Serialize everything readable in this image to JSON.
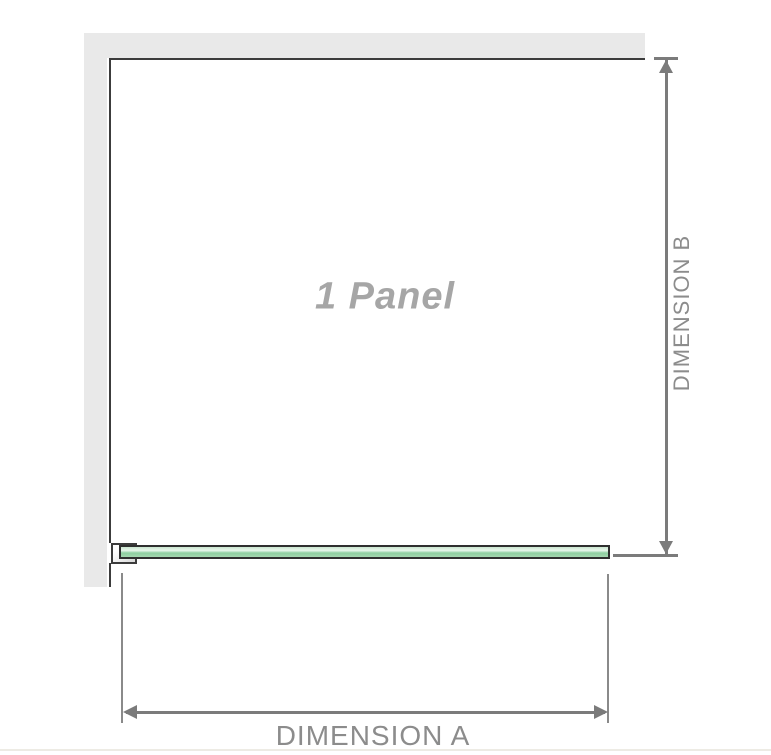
{
  "diagram": {
    "panel_label": "1 Panel",
    "dimension_a": {
      "label": "DIMENSION A"
    },
    "dimension_b": {
      "label": "DIMENSION B"
    }
  },
  "colors": {
    "background": "#ffffff",
    "wall": "#e9e9e9",
    "outline": "#3c3c3c",
    "glass-border": "#2f2f2f",
    "glass-top": "#c9e6cf",
    "glass-light": "#e9f6ec",
    "glass-mid": "#8ecfa0",
    "glass-bottom": "#a5d7b0",
    "dimension-line": "#7b7b7b",
    "extension-line": "#8a8a8a",
    "label-text": "#8c8c8c",
    "panel-label-text": "#a6a6a6",
    "bottom-strip": "#edebe4"
  }
}
